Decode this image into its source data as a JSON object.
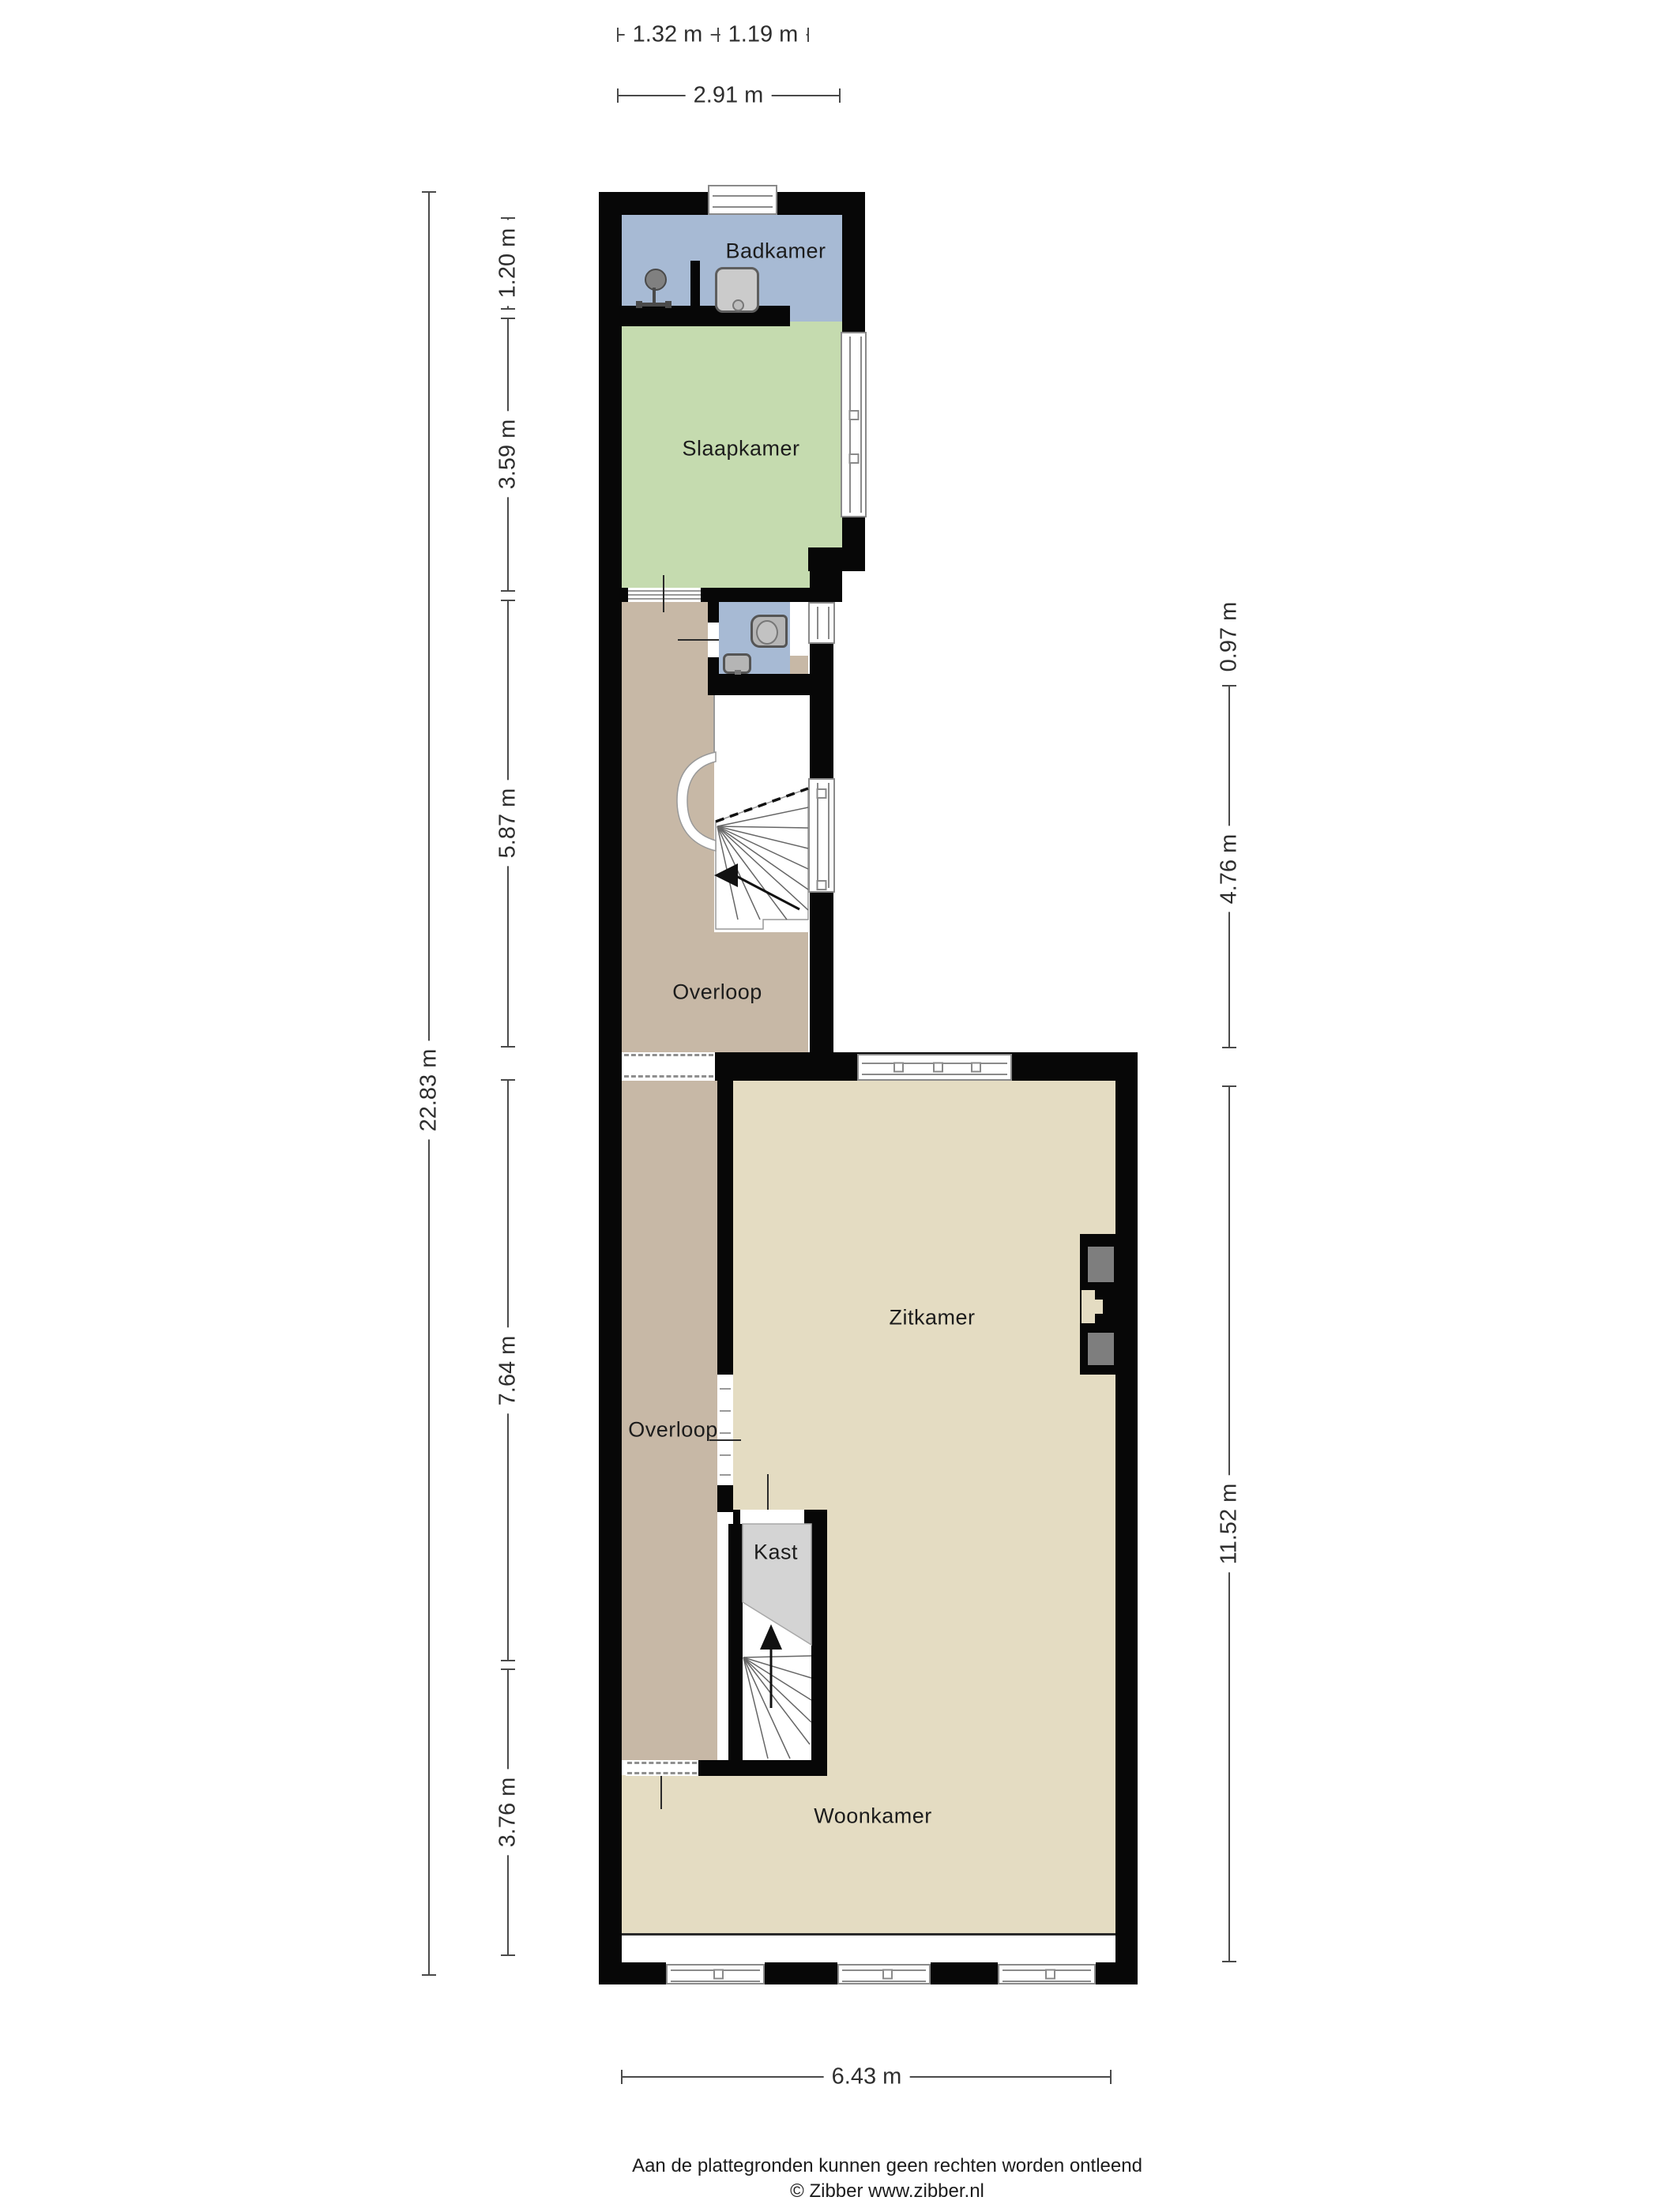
{
  "title": "Plattegrond verdieping",
  "rooms": {
    "badkamer": {
      "label": "Badkamer",
      "color": "#a7bad4"
    },
    "slaapkamer": {
      "label": "Slaapkamer",
      "color": "#c5dbaf"
    },
    "overloop1": {
      "label": "Overloop",
      "color": "#c7b8a6"
    },
    "wc": {
      "label": "",
      "color": "#a7bad4"
    },
    "zitkamer": {
      "label": "Zitkamer",
      "color": "#e4dcc2"
    },
    "overloop2": {
      "label": "Overloop",
      "color": "#c7b8a6"
    },
    "kast": {
      "label": "Kast",
      "color": "#d4d4d4"
    },
    "woonkamer": {
      "label": "Woonkamer",
      "color": "#e4dcc2"
    }
  },
  "dimensions": {
    "top": {
      "seg1": "1.32 m",
      "seg2": "1.19 m",
      "total": "2.91 m"
    },
    "left": {
      "seg1": "1.20 m",
      "seg2": "3.59 m",
      "seg3": "5.87 m",
      "seg4": "7.64 m",
      "seg5": "3.76 m",
      "total": "22.83 m"
    },
    "right": {
      "seg1": "0.97 m",
      "seg2": "4.76 m",
      "total": "11.52 m"
    },
    "bottom": {
      "total": "6.43 m"
    }
  },
  "footer": {
    "disclaimer": "Aan de plattegronden kunnen geen rechten worden ontleend",
    "copyright": "© Zibber www.zibber.nl"
  },
  "colors": {
    "wall": "#070707",
    "dimension_line": "#4a4a4a",
    "fixture_gray": "#b5b5b5",
    "kast_gray": "#d4d4d4",
    "niche_gray": "#7e7e7e"
  }
}
